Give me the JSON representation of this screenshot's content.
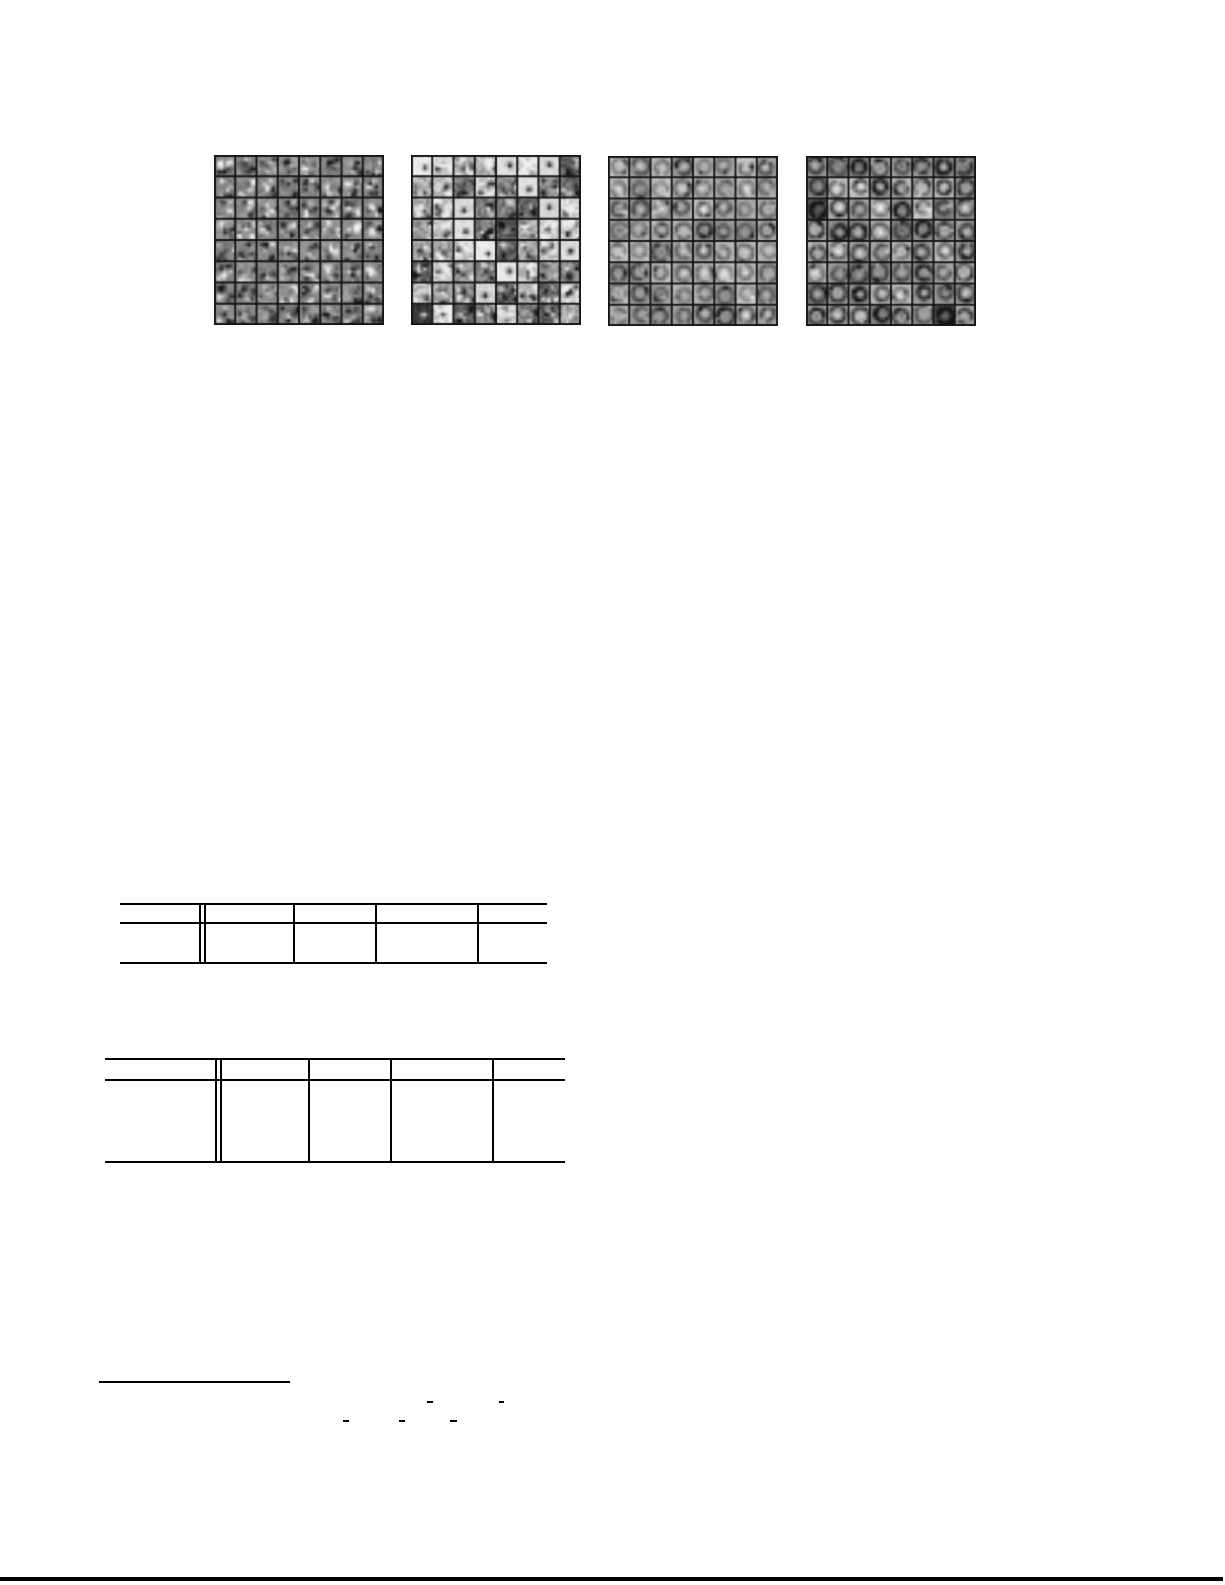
{
  "page": {
    "kind": "academic-paper-page",
    "background": "#ffffff",
    "ink": "#000000",
    "visible_text": ""
  },
  "figure": {
    "name": "learned-filter-grids",
    "description": "four 8x8 mosaics of small grayscale learned filter patches",
    "cell_border_color": "#161616",
    "grids": [
      {
        "id": "filter-grid-1",
        "rows": 8,
        "cols": 8,
        "size": 170,
        "style": "speckle",
        "seed": 101
      },
      {
        "id": "filter-grid-2",
        "rows": 8,
        "cols": 8,
        "size": 170,
        "style": "dots",
        "seed": 202
      },
      {
        "id": "filter-grid-3",
        "rows": 8,
        "cols": 8,
        "size": 170,
        "style": "rings",
        "seed": 303
      },
      {
        "id": "filter-grid-4",
        "rows": 8,
        "cols": 8,
        "size": 170,
        "style": "rings-bold",
        "seed": 404
      }
    ]
  },
  "tables": [
    {
      "id": "table-1",
      "columns": 5,
      "header_rows": 1,
      "body_rows": 1,
      "double_rule_after_col": 1,
      "cells_empty": true
    },
    {
      "id": "table-2",
      "columns": 5,
      "header_rows": 1,
      "body_rows": 1,
      "double_rule_after_col": 1,
      "cells_empty": true
    }
  ],
  "footnote": {
    "has_rule": true,
    "text": ""
  },
  "math_marks": {
    "description": "isolated minus-sign / fraction-bar fragments of otherwise invisible formulas",
    "dashes": [
      {
        "x": 427,
        "y": 1401,
        "w": 6
      },
      {
        "x": 499,
        "y": 1401,
        "w": 5
      },
      {
        "x": 343,
        "y": 1420,
        "w": 6
      },
      {
        "x": 399,
        "y": 1420,
        "w": 6
      },
      {
        "x": 450,
        "y": 1420,
        "w": 7
      }
    ]
  },
  "bottom_rule": {
    "full_width": true
  }
}
